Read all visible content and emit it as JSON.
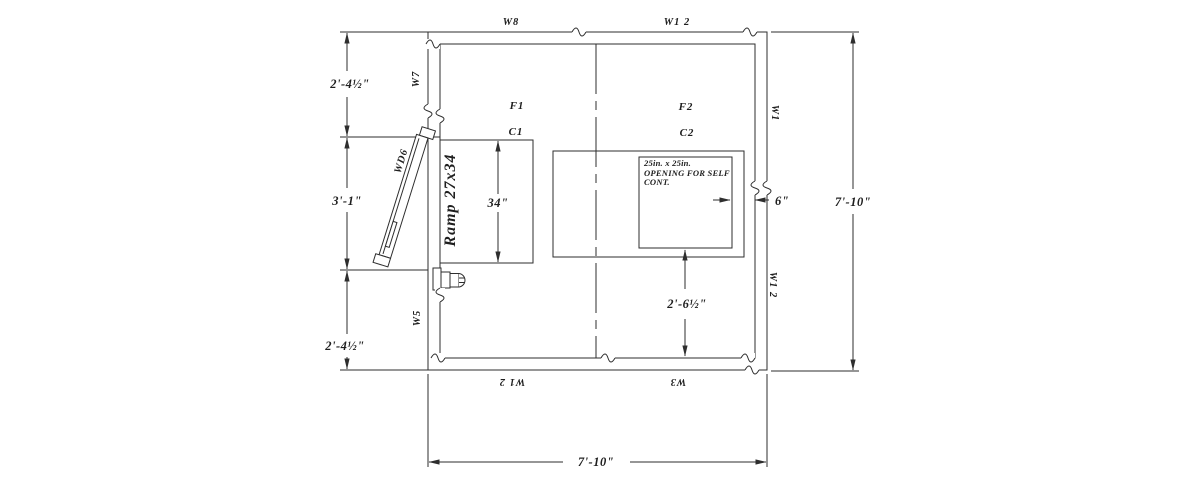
{
  "plan": {
    "wall_labels": {
      "top_left": "W8",
      "top_right": "W1 2",
      "left_upper": "W7",
      "left_door": "WD6",
      "left_lower": "W5",
      "right_upper": "W1",
      "right_lower": "W1 2",
      "bottom_left": "W1 2",
      "bottom_right": "W3"
    },
    "room_labels": {
      "f1": "F1",
      "c1": "C1",
      "f2": "F2",
      "c2": "C2"
    },
    "ramp_label": "Ramp 27x34",
    "opening_note": [
      "25in. x 25in.",
      "OPENING FOR SELF",
      "CONT."
    ],
    "dimensions": {
      "left_top": "2'-4½\"",
      "left_middle": "3'-1\"",
      "left_bottom": "2'-4½\"",
      "right_overall": "7'-10\"",
      "bottom_overall": "7'-10\"",
      "c1_height": "34\"",
      "opening_offset": "6\"",
      "opening_to_wall": "2'-6½\""
    },
    "colors": {
      "line": "#2e2e2e",
      "accent_blue": "#1a1ae6"
    }
  }
}
